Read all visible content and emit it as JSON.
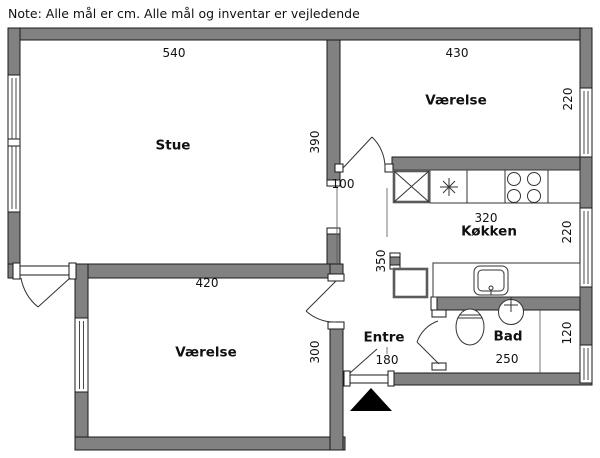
{
  "note": "Note: Alle mål er cm. Alle mål og inventar er vejledende",
  "rooms": {
    "stue": {
      "name": "Stue",
      "width_cm": "540",
      "depth_cm": "390"
    },
    "vaerelse_top": {
      "name": "Værelse",
      "width_cm": "430",
      "depth_cm": "220"
    },
    "koekken": {
      "name": "Køkken",
      "width_cm": "320",
      "depth_cm": "220"
    },
    "vaerelse_bottom": {
      "name": "Værelse",
      "width_cm": "420",
      "depth_cm": "300"
    },
    "entre": {
      "name": "Entre",
      "door_width_cm": "180",
      "hall_depth_cm": "350",
      "passage_width_cm": "100"
    },
    "bad": {
      "name": "Bad",
      "width_cm": "250",
      "depth_cm": "120"
    }
  },
  "fixtures": [
    "refrigerator-box",
    "extractor-star",
    "stove-4-burner",
    "kitchen-sink",
    "cabinet-box",
    "toilet",
    "wash-basin",
    "shower-partition"
  ],
  "entrance_marker": "black-triangle",
  "colors": {
    "wall": "#818181",
    "line": "#1a1a1a",
    "background": "#ffffff",
    "marker": "#000000"
  }
}
